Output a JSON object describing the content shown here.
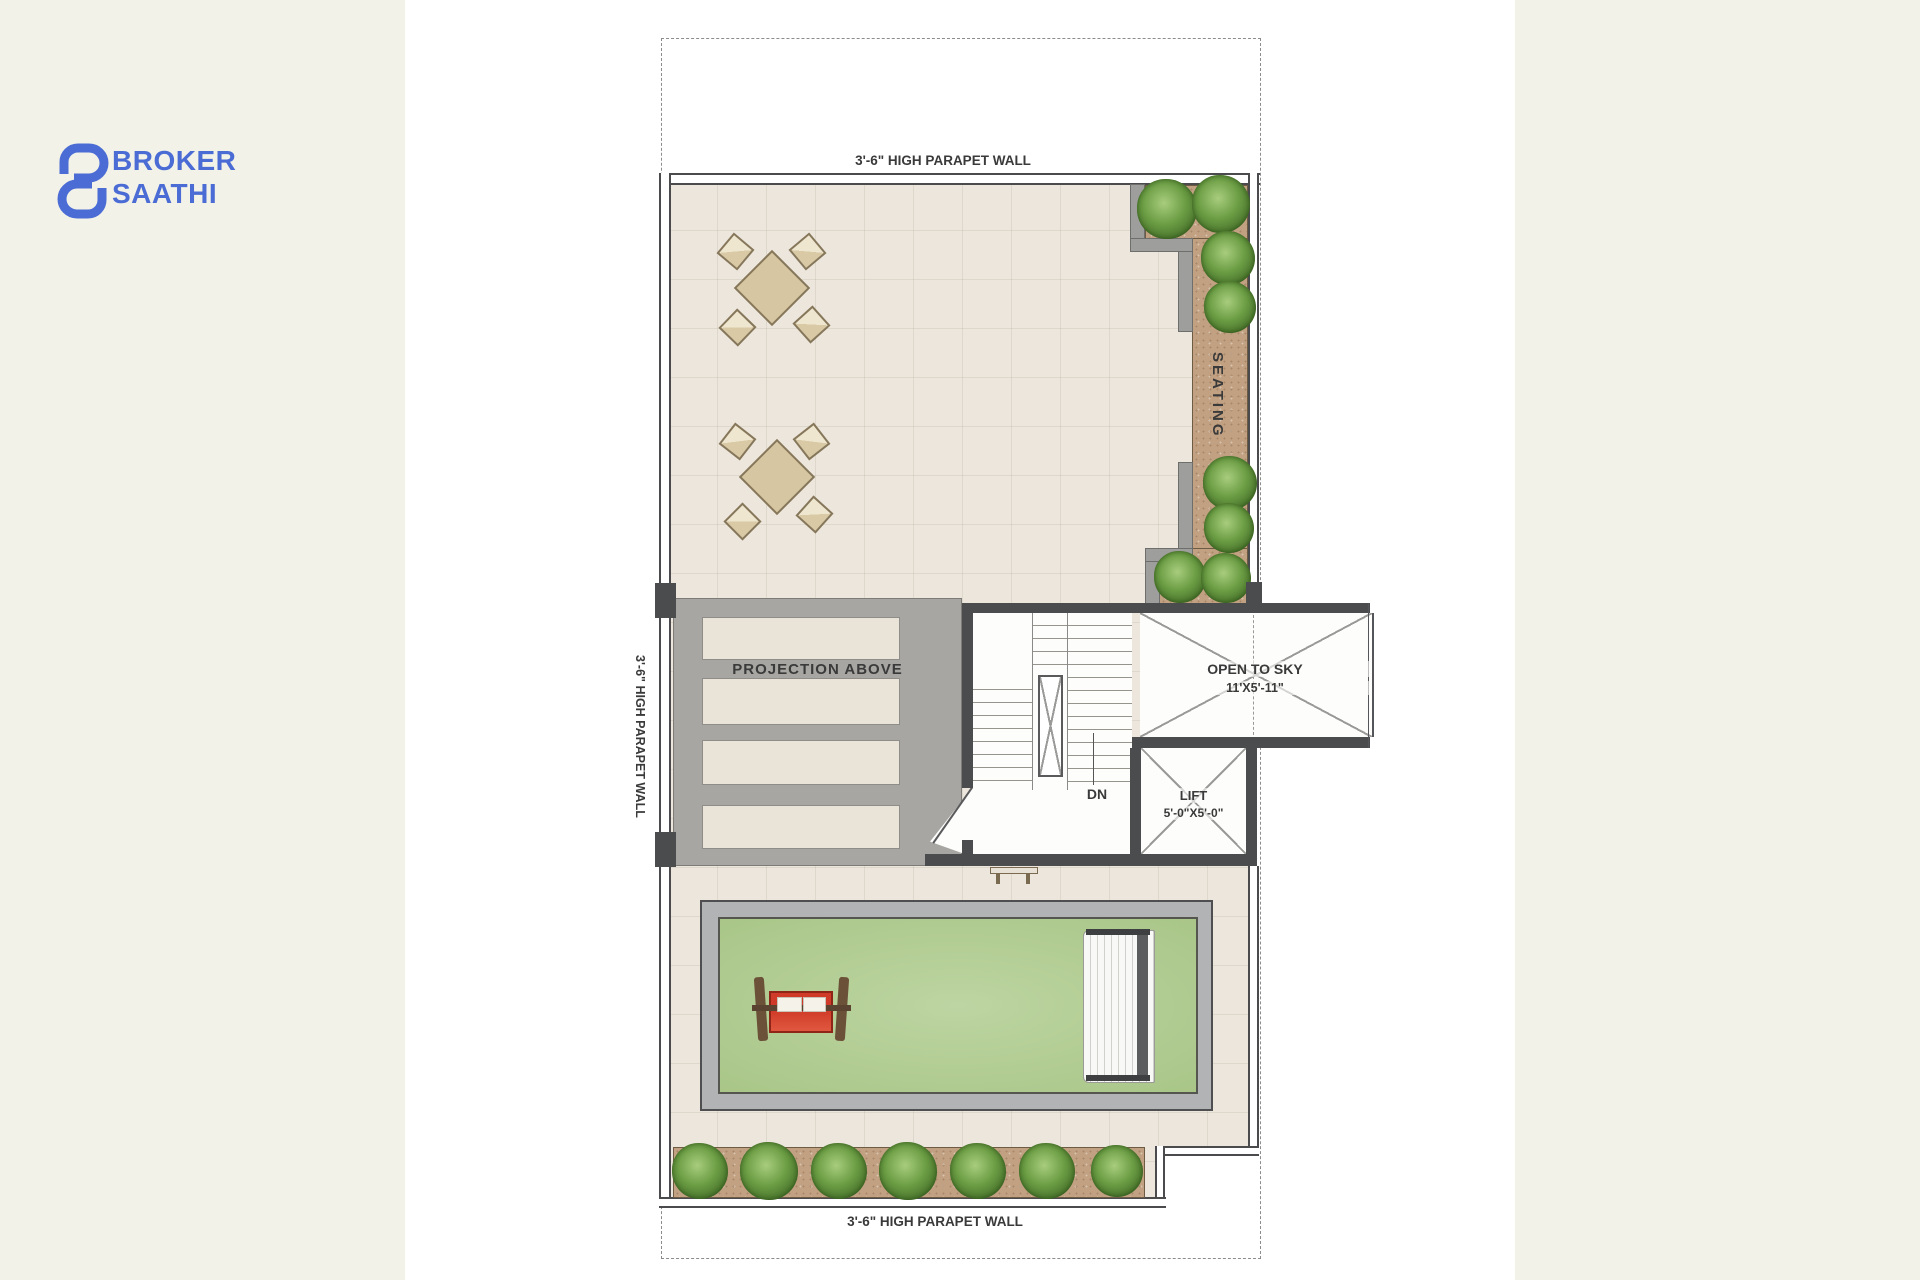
{
  "logo": {
    "line1": "BROKER",
    "line2": "SAATHI",
    "brand_color": "#4a6cd4"
  },
  "plan": {
    "labels": {
      "top_parapet": "3'-6\" HIGH PARAPET WALL",
      "left_parapet": "3'-6\" HIGH PARAPET WALL",
      "bottom_parapet": "3'-6\" HIGH PARAPET WALL"
    },
    "areas": {
      "seating": {
        "label": "SEATING"
      },
      "projection": {
        "label": "PROJECTION ABOVE"
      },
      "stairs": {
        "down_label": "DN"
      },
      "open_to_sky": {
        "label": "OPEN TO SKY",
        "dimension": "11'X5'-11\""
      },
      "lift": {
        "label": "LIFT",
        "dimension": "5'-0\"X5'-0\""
      }
    },
    "colors": {
      "wall_dark": "#4b4c4e",
      "terrace_floor": "#ece6dc",
      "projection_gray": "#a7a6a2",
      "planter_brown": "#c2a183",
      "shrub_green": "#5d8f38",
      "lawn_green": "#b3cc95",
      "bench_red": "#cf3b28",
      "background_cream": "#f2f2e9",
      "canvas_white": "#ffffff"
    }
  }
}
